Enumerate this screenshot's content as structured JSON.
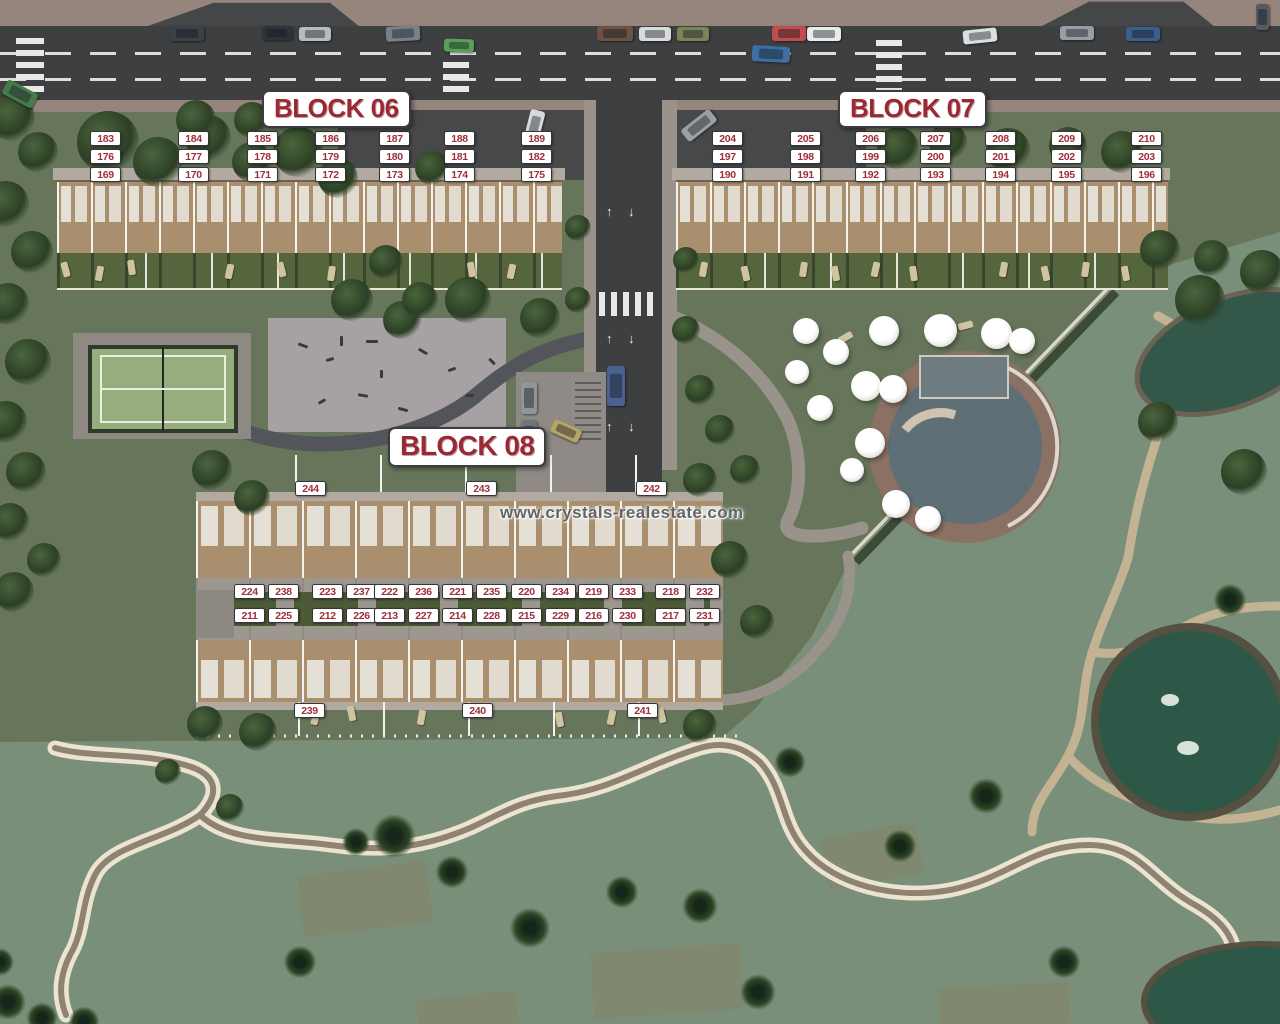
{
  "watermark": "www.crystals-realestate.com",
  "colors": {
    "unit_label_text": "#9e2f38",
    "unit_label_bg": "#ffffff",
    "block_label_text": "#9c2833",
    "watermark_text": "#636466"
  },
  "blocks": {
    "block06": {
      "label": "BLOCK 06",
      "unit_rows": [
        [
          "183",
          "184",
          "185",
          "186",
          "187",
          "188",
          "189"
        ],
        [
          "176",
          "177",
          "178",
          "179",
          "180",
          "181",
          "182"
        ],
        [
          "169",
          "170",
          "171",
          "172",
          "173",
          "174",
          "175"
        ]
      ]
    },
    "block07": {
      "label": "BLOCK 07",
      "unit_rows": [
        [
          "204",
          "205",
          "206",
          "207",
          "208",
          "209",
          "210"
        ],
        [
          "197",
          "198",
          "199",
          "200",
          "201",
          "202",
          "203"
        ],
        [
          "190",
          "191",
          "192",
          "193",
          "194",
          "195",
          "196"
        ]
      ]
    },
    "block08": {
      "label": "BLOCK 08",
      "top_units": [
        "244",
        "243",
        "242"
      ],
      "bottom_units": [
        "239",
        "240",
        "241"
      ],
      "pair_rows": [
        [
          [
            "224",
            "238"
          ],
          [
            "223",
            "237"
          ],
          [
            "222",
            "236"
          ],
          [
            "221",
            "235"
          ],
          [
            "220",
            "234"
          ],
          [
            "219",
            "233"
          ],
          [
            "218",
            "232"
          ]
        ],
        [
          [
            "211",
            "225"
          ],
          [
            "212",
            "226"
          ],
          [
            "213",
            "227"
          ],
          [
            "214",
            "228"
          ],
          [
            "215",
            "229"
          ],
          [
            "216",
            "230"
          ],
          [
            "217",
            "231"
          ]
        ]
      ]
    }
  }
}
